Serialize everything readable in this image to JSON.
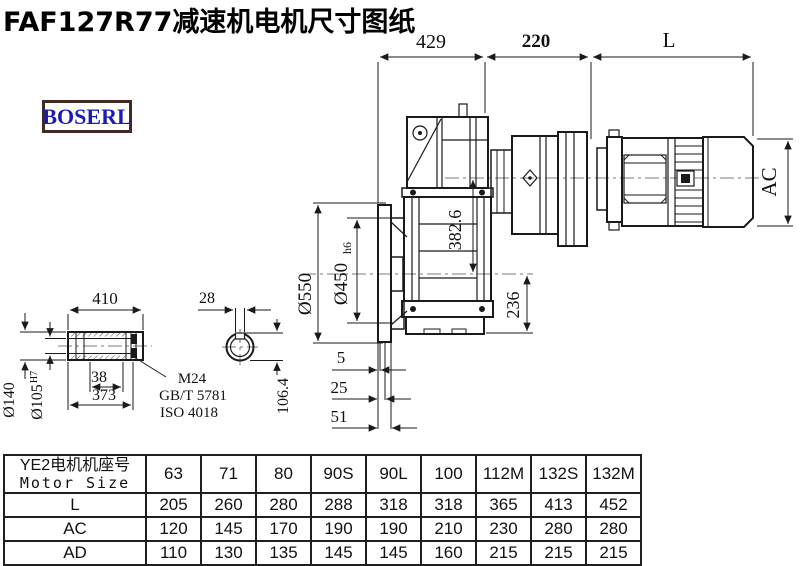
{
  "page": {
    "title": "FAF127R77减速机电机尺寸图纸",
    "logo": "BOSERL"
  },
  "dimensions": {
    "top_429": "429",
    "top_220": "220",
    "top_L": "L",
    "motor_ac": "AC",
    "flange_outer_dia": "Ø550",
    "flange_spigot_dia": "Ø450",
    "flange_spigot_tol": "h6",
    "axis_distance": "382.6",
    "center_to_base": "236",
    "offset_5": "5",
    "offset_25": "25",
    "offset_51": "51",
    "shaft_length": "410",
    "key_width": "28",
    "shaft_outer_dia": "Ø140",
    "shaft_bore_dia": "Ø105",
    "shaft_bore_tol": "H7",
    "groove_38": "38",
    "length_373": "373",
    "bolt_spec": "M24",
    "std_gb": "GB/T 5781",
    "std_iso": "ISO 4018",
    "bore_key_height": "106.4"
  },
  "table": {
    "row_header_line1": "YE2电机机座号",
    "row_header_line2": "Motor Size",
    "columns": [
      "63",
      "71",
      "80",
      "90S",
      "90L",
      "100",
      "112M",
      "132S",
      "132M"
    ],
    "rows": [
      {
        "label": "L",
        "values": [
          "205",
          "260",
          "280",
          "288",
          "318",
          "318",
          "365",
          "413",
          "452"
        ]
      },
      {
        "label": "AC",
        "values": [
          "120",
          "145",
          "170",
          "190",
          "190",
          "210",
          "230",
          "280",
          "280"
        ]
      },
      {
        "label": "AD",
        "values": [
          "110",
          "130",
          "135",
          "145",
          "145",
          "160",
          "215",
          "215",
          "215"
        ]
      }
    ]
  }
}
